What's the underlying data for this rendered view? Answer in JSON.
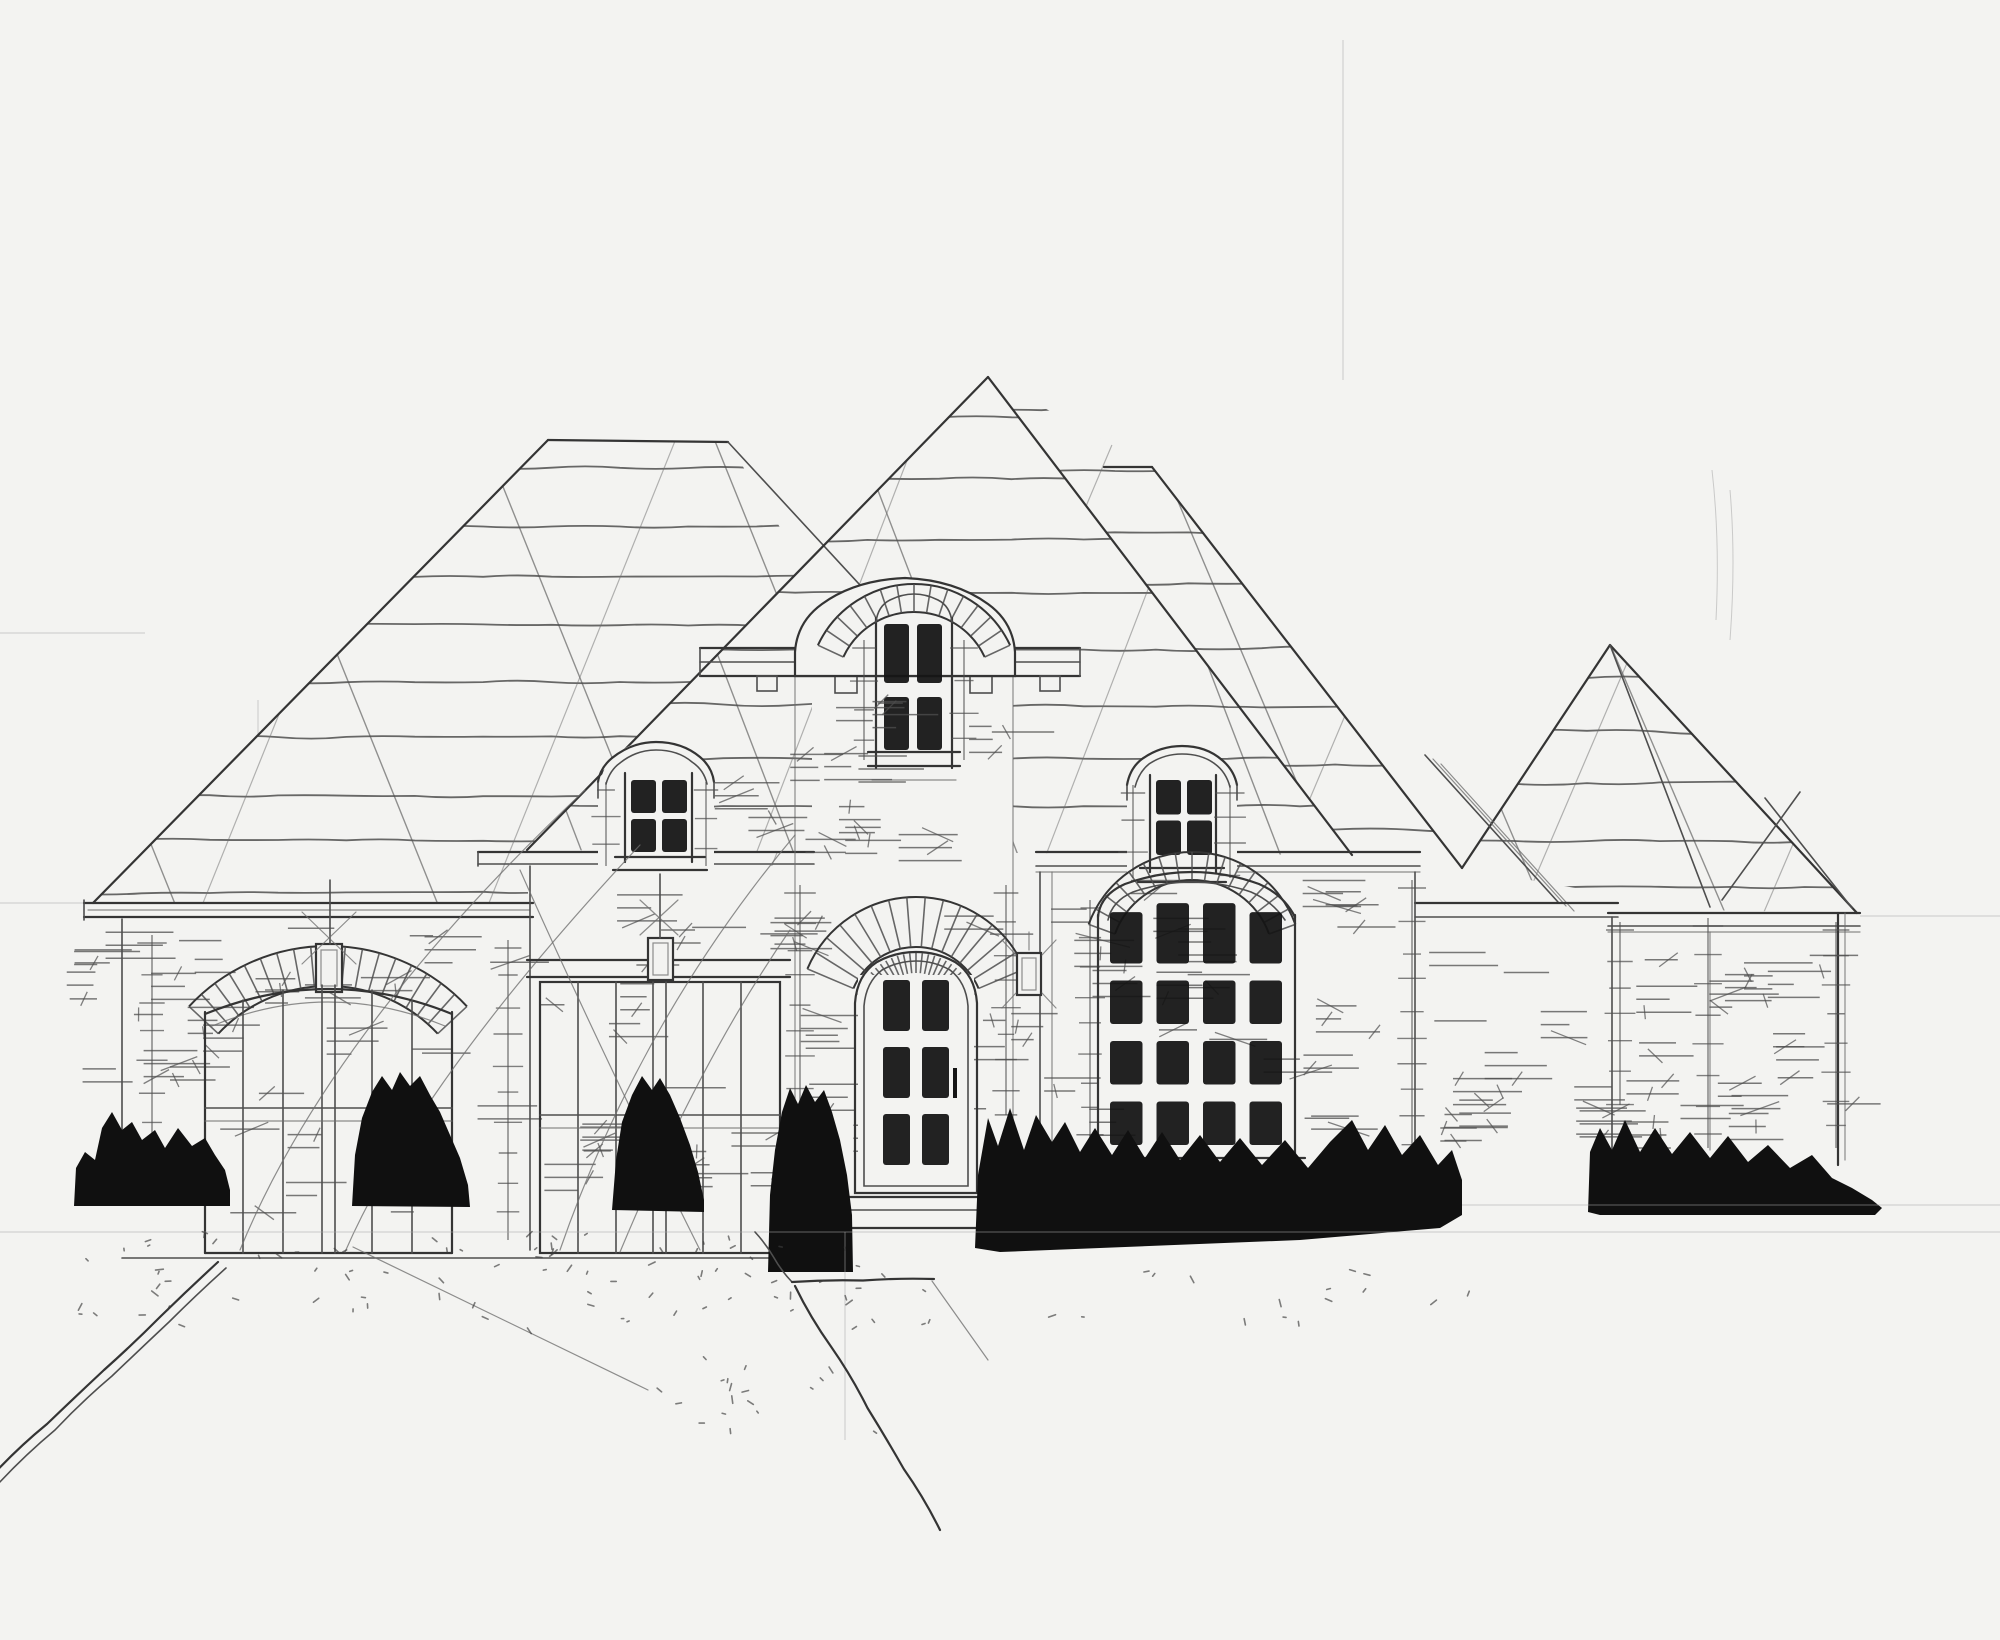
{
  "meta": {
    "title": "Hand-drawn front elevation sketch of a French country style brick house",
    "medium": "pencil and black marker on white paper",
    "text_content_present": false
  },
  "palette": {
    "paper": "#f3f3f1",
    "ink": "#343434",
    "ink_soft": "#4e4e4e",
    "pencil": "#6e6e6e",
    "faint": "#a8a8a8",
    "glass_dark": "#141414",
    "bush_dark": "#101010"
  },
  "house": {
    "style": "French country / European cottage elevation",
    "roof": {
      "type": "steep hip and gable combination",
      "texture": "wavy shingle course lines with long diagonal guide hatching",
      "main_gable_apex": "tall central gable above entry tower"
    },
    "windows": {
      "tower_window": {
        "shape": "arched, radiating voussoir fan",
        "cols": 2,
        "rows": 2
      },
      "left_dormer": {
        "shape": "arched-cap dormer",
        "cols": 2,
        "rows": 2
      },
      "right_dormer": {
        "shape": "arched-cap dormer",
        "cols": 2,
        "rows": 2
      },
      "great_window": {
        "shape": "segmental-arch picture window",
        "cols": 4,
        "rows": 4
      },
      "entry_door": {
        "shape": "arched glazed front door",
        "cols": 2,
        "rows": 3
      }
    },
    "doors": {
      "garage_door_count": 2,
      "left_garage": "arched double carriage door with brick voussoir arch and keystone",
      "center_garage": "square-top double carriage door with header band",
      "entry": "arched entry door with hatched surround and brick fan"
    },
    "fixtures": {
      "wall_lantern_count": 3
    },
    "landscape": {
      "shrub_cluster_count": 6,
      "driveway": "stippled gravel drive exiting bottom-left with doubled wavy edge",
      "front_walk": "short walk from entry stoop with wavy edges",
      "ground": "faint horizontal ground guide lines"
    }
  }
}
